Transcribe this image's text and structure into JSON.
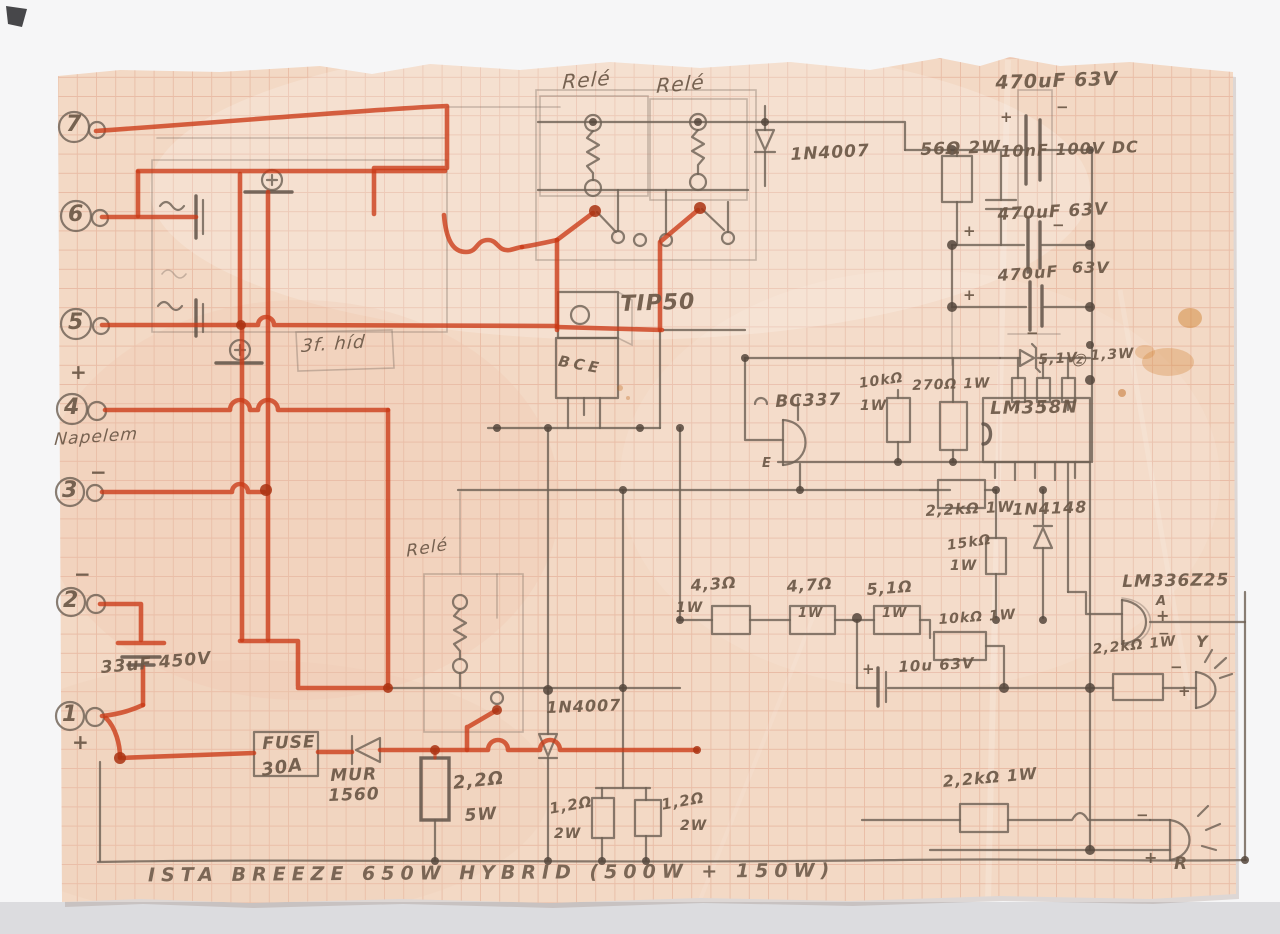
{
  "title": "ISTA BREEZE 650W HYBRID (500W + 150W)",
  "colors": {
    "paper": "#f3d9c5",
    "grid": "#d98f74",
    "pencil": "#6f6156",
    "red_crayon": "#cb3a16",
    "stain": "#cf7f2a"
  },
  "labels": [
    {
      "id": "terminal-7",
      "t": "7",
      "x": 66,
      "y": 112,
      "fs": 22
    },
    {
      "id": "terminal-6",
      "t": "6",
      "x": 68,
      "y": 202,
      "fs": 22
    },
    {
      "id": "terminal-5",
      "t": "5",
      "x": 68,
      "y": 310,
      "fs": 22
    },
    {
      "id": "terminal-4-plus",
      "t": "+",
      "x": 70,
      "y": 360,
      "fs": 20
    },
    {
      "id": "terminal-4",
      "t": "4",
      "x": 64,
      "y": 395,
      "fs": 22
    },
    {
      "id": "napelem-note",
      "t": "Napelem",
      "x": 55,
      "y": 430,
      "fs": 17,
      "rot": -4,
      "cls": "cursive"
    },
    {
      "id": "terminal-3-minus",
      "t": "−",
      "x": 90,
      "y": 460,
      "fs": 20
    },
    {
      "id": "terminal-3",
      "t": "3",
      "x": 62,
      "y": 478,
      "fs": 22
    },
    {
      "id": "terminal-2-minus",
      "t": "−",
      "x": 74,
      "y": 562,
      "fs": 20
    },
    {
      "id": "terminal-2",
      "t": "2",
      "x": 63,
      "y": 588,
      "fs": 22
    },
    {
      "id": "cap-33uf",
      "t": "33uF 450V",
      "x": 100,
      "y": 658,
      "fs": 17,
      "rot": -5
    },
    {
      "id": "terminal-1",
      "t": "1",
      "x": 62,
      "y": 702,
      "fs": 22
    },
    {
      "id": "terminal-1-plus",
      "t": "+",
      "x": 72,
      "y": 730,
      "fs": 20
    },
    {
      "id": "relay-1",
      "t": "Relé",
      "x": 563,
      "y": 70,
      "fs": 20,
      "rot": -5,
      "cls": "cursive"
    },
    {
      "id": "relay-2",
      "t": "Relé",
      "x": 657,
      "y": 74,
      "fs": 20,
      "rot": -5,
      "cls": "cursive"
    },
    {
      "id": "cap-470uf-1",
      "t": "470uF 63V",
      "x": 995,
      "y": 72,
      "fs": 19,
      "rot": -2
    },
    {
      "id": "cap-470uf-1-plus",
      "t": "+",
      "x": 1000,
      "y": 108,
      "fs": 15
    },
    {
      "id": "cap-470uf-1-minus",
      "t": "−",
      "x": 1056,
      "y": 98,
      "fs": 15
    },
    {
      "id": "diode-1n4007-top",
      "t": "1N4007",
      "x": 790,
      "y": 145,
      "fs": 17,
      "rot": -3
    },
    {
      "id": "r-56ohm",
      "t": "56Ω 2W",
      "x": 920,
      "y": 140,
      "fs": 17,
      "rot": -2
    },
    {
      "id": "cap-10nf",
      "t": "10nF 100V DC",
      "x": 1000,
      "y": 142,
      "fs": 16,
      "rot": -2
    },
    {
      "id": "cap-470uf-2",
      "t": "470uF 63V",
      "x": 997,
      "y": 205,
      "fs": 17,
      "rot": -3
    },
    {
      "id": "cap-470uf-2-plus",
      "t": "+",
      "x": 963,
      "y": 222,
      "fs": 15
    },
    {
      "id": "cap-470uf-2-minus",
      "t": "−",
      "x": 1052,
      "y": 216,
      "fs": 15
    },
    {
      "id": "cap-470uf-3",
      "t": "470uF",
      "x": 997,
      "y": 266,
      "fs": 16,
      "rot": -4
    },
    {
      "id": "cap-470uf-3-v",
      "t": "63V",
      "x": 1072,
      "y": 258,
      "fs": 16
    },
    {
      "id": "cap-470uf-3-plus",
      "t": "+",
      "x": 963,
      "y": 286,
      "fs": 15
    },
    {
      "id": "tip50",
      "t": "TIP50",
      "x": 620,
      "y": 292,
      "fs": 22,
      "rot": -2
    },
    {
      "id": "bridge-note",
      "t": "3f. híd",
      "x": 302,
      "y": 336,
      "fs": 18,
      "rot": -4,
      "cls": "cursive"
    },
    {
      "id": "tip50-pins",
      "t": "BCE",
      "x": 560,
      "y": 352,
      "fs": 15,
      "rot": 10,
      "ls": 4
    },
    {
      "id": "zener-minus",
      "t": "−",
      "x": 1026,
      "y": 324,
      "fs": 15
    },
    {
      "id": "zener-v",
      "t": "5,1V",
      "x": 1038,
      "y": 352,
      "fs": 14,
      "rot": -3
    },
    {
      "id": "zener-z",
      "t": "Ⓩ",
      "x": 1072,
      "y": 350,
      "fs": 13
    },
    {
      "id": "zener-w",
      "t": "1,3W",
      "x": 1090,
      "y": 348,
      "fs": 14,
      "rot": -3
    },
    {
      "id": "bc337",
      "t": "BC337",
      "x": 775,
      "y": 392,
      "fs": 17,
      "rot": -2
    },
    {
      "id": "bc337-e",
      "t": "E",
      "x": 762,
      "y": 456,
      "fs": 13
    },
    {
      "id": "r-10k-1",
      "t": "10kΩ",
      "x": 858,
      "y": 376,
      "fs": 14,
      "rot": -8
    },
    {
      "id": "r-10k-1-w",
      "t": "1W",
      "x": 860,
      "y": 398,
      "fs": 14
    },
    {
      "id": "r-270",
      "t": "270Ω 1W",
      "x": 912,
      "y": 378,
      "fs": 14,
      "rot": -2
    },
    {
      "id": "ic-lm358",
      "t": "LM358N",
      "x": 990,
      "y": 398,
      "fs": 18,
      "rot": -1
    },
    {
      "id": "r-2k2-1",
      "t": "2,2kΩ 1W",
      "x": 925,
      "y": 502,
      "fs": 15,
      "rot": -3
    },
    {
      "id": "d-1n4148",
      "t": "1N4148",
      "x": 1012,
      "y": 500,
      "fs": 16,
      "rot": -2
    },
    {
      "id": "r-15k",
      "t": "15kΩ",
      "x": 946,
      "y": 538,
      "fs": 14,
      "rot": -8
    },
    {
      "id": "r-15k-w",
      "t": "1W",
      "x": 950,
      "y": 558,
      "fs": 14
    },
    {
      "id": "lm336z25",
      "t": "LM336Z25",
      "x": 1122,
      "y": 572,
      "fs": 17,
      "rot": -1
    },
    {
      "id": "lm336-a",
      "t": "A",
      "x": 1156,
      "y": 594,
      "fs": 13
    },
    {
      "id": "lm336-plus",
      "t": "+",
      "x": 1156,
      "y": 606,
      "fs": 16
    },
    {
      "id": "lm336-minus",
      "t": "−",
      "x": 1158,
      "y": 626,
      "fs": 14
    },
    {
      "id": "r-4r3",
      "t": "4,3Ω",
      "x": 690,
      "y": 576,
      "fs": 16,
      "rot": -4
    },
    {
      "id": "r-4r3-w",
      "t": "1W",
      "x": 676,
      "y": 600,
      "fs": 14
    },
    {
      "id": "r-4r7",
      "t": "4,7Ω",
      "x": 786,
      "y": 577,
      "fs": 16,
      "rot": -4
    },
    {
      "id": "r-4r7-w",
      "t": "1W",
      "x": 798,
      "y": 606,
      "fs": 13
    },
    {
      "id": "r-5r1",
      "t": "5,1Ω",
      "x": 866,
      "y": 580,
      "fs": 16,
      "rot": -4
    },
    {
      "id": "r-5r1-w",
      "t": "1W",
      "x": 882,
      "y": 606,
      "fs": 13
    },
    {
      "id": "r-10k-2",
      "t": "10kΩ 1W",
      "x": 938,
      "y": 612,
      "fs": 14,
      "rot": -4
    },
    {
      "id": "cap-10u",
      "t": "10u 63V",
      "x": 898,
      "y": 658,
      "fs": 15,
      "rot": -3
    },
    {
      "id": "cap-10u-plus",
      "t": "+",
      "x": 862,
      "y": 660,
      "fs": 15
    },
    {
      "id": "r-2k2-2",
      "t": "2,2kΩ 1W",
      "x": 1092,
      "y": 642,
      "fs": 14,
      "rot": -6
    },
    {
      "id": "led-yellow",
      "t": "Y",
      "x": 1196,
      "y": 632,
      "fs": 16
    },
    {
      "id": "led-yellow-minus",
      "t": "−",
      "x": 1170,
      "y": 658,
      "fs": 15
    },
    {
      "id": "led-yellow-plus",
      "t": "+",
      "x": 1178,
      "y": 682,
      "fs": 15
    },
    {
      "id": "relay-3",
      "t": "Relé",
      "x": 406,
      "y": 542,
      "fs": 17,
      "rot": -10,
      "cls": "cursive"
    },
    {
      "id": "d-1n4007-bottom",
      "t": "1N4007",
      "x": 546,
      "y": 698,
      "fs": 16,
      "rot": -2
    },
    {
      "id": "fuse",
      "t": "FUSE",
      "x": 262,
      "y": 734,
      "fs": 17,
      "rot": -2
    },
    {
      "id": "fuse-rating",
      "t": "30A",
      "x": 260,
      "y": 760,
      "fs": 18,
      "rot": -8
    },
    {
      "id": "d-mur",
      "t": "MUR",
      "x": 330,
      "y": 766,
      "fs": 17,
      "rot": -2
    },
    {
      "id": "d-mur-2",
      "t": "1560",
      "x": 328,
      "y": 786,
      "fs": 17,
      "rot": -2
    },
    {
      "id": "r-2r2",
      "t": "2,2Ω",
      "x": 452,
      "y": 773,
      "fs": 18,
      "rot": -6
    },
    {
      "id": "r-2r2-w",
      "t": "5W",
      "x": 464,
      "y": 806,
      "fs": 17,
      "rot": -4
    },
    {
      "id": "r-1r2-a",
      "t": "1,2Ω",
      "x": 548,
      "y": 800,
      "fs": 15,
      "rot": -10
    },
    {
      "id": "r-1r2-a-w",
      "t": "2W",
      "x": 554,
      "y": 826,
      "fs": 14
    },
    {
      "id": "r-1r2-b",
      "t": "1,2Ω",
      "x": 660,
      "y": 796,
      "fs": 15,
      "rot": -10
    },
    {
      "id": "r-1r2-b-w",
      "t": "2W",
      "x": 680,
      "y": 818,
      "fs": 14
    },
    {
      "id": "r-2k2-3",
      "t": "2,2kΩ 1W",
      "x": 942,
      "y": 772,
      "fs": 16,
      "rot": -5
    },
    {
      "id": "led-red-minus",
      "t": "−",
      "x": 1136,
      "y": 806,
      "fs": 15
    },
    {
      "id": "led-red-plus",
      "t": "+",
      "x": 1144,
      "y": 848,
      "fs": 16
    },
    {
      "id": "led-red",
      "t": "R",
      "x": 1174,
      "y": 854,
      "fs": 17
    }
  ]
}
